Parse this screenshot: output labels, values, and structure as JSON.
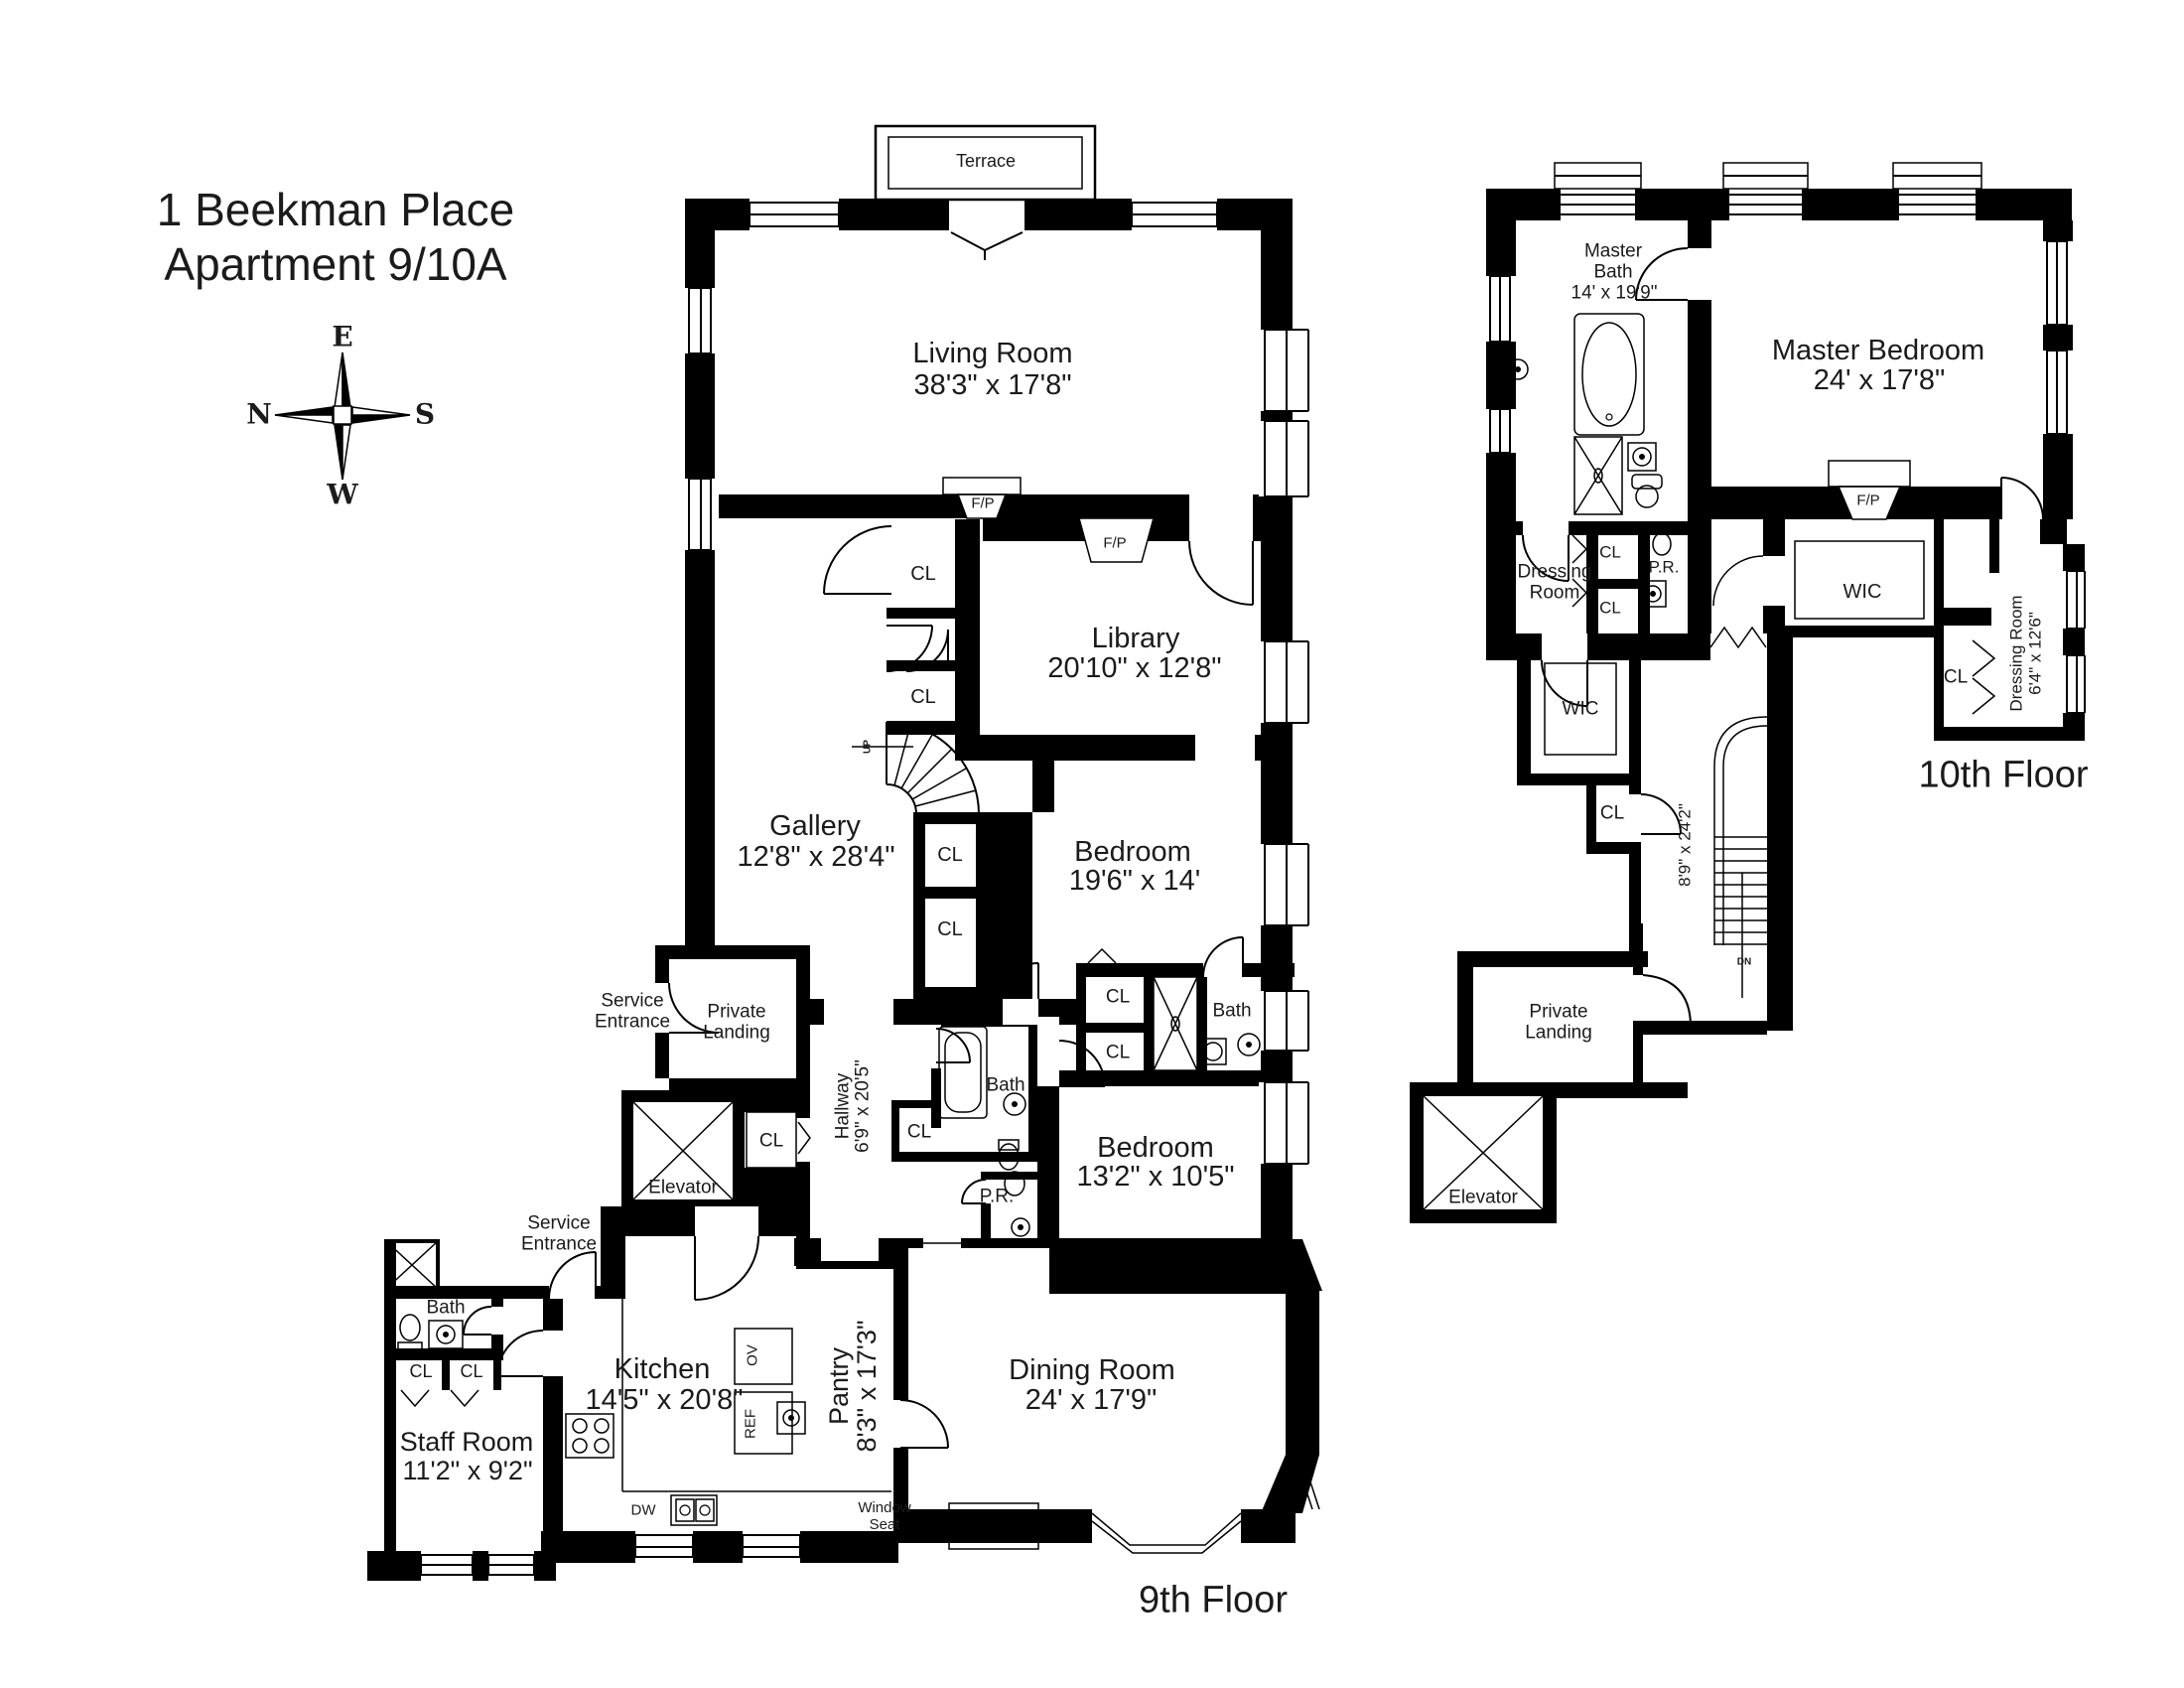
{
  "page": {
    "title_line1": "1 Beekman Place",
    "title_line2": "Apartment 9/10A"
  },
  "compass": {
    "e": "E",
    "n": "N",
    "s": "S",
    "w": "W"
  },
  "abbr": {
    "closet": "CL",
    "fireplace": "F/P",
    "powder_room": "P.R.",
    "walk_in_closet": "WIC",
    "up": "UP",
    "down": "DN",
    "dishwasher": "DW",
    "oven": "OV",
    "refrigerator": "REF"
  },
  "floor9": {
    "label": "9th Floor",
    "terrace": "Terrace",
    "living_room": {
      "name": "Living Room",
      "dims": "38'3\" x 17'8\""
    },
    "library": {
      "name": "Library",
      "dims": "20'10\" x 12'8\""
    },
    "gallery": {
      "name": "Gallery",
      "dims": "12'8\" x 28'4\""
    },
    "bedroom_large": {
      "name": "Bedroom",
      "dims": "19'6\" x 14'"
    },
    "bedroom_small": {
      "name": "Bedroom",
      "dims": "13'2\" x 10'5\""
    },
    "dining_room": {
      "name": "Dining Room",
      "dims": "24' x 17'9\""
    },
    "kitchen": {
      "name": "Kitchen",
      "dims": "14'5\" x 20'8\""
    },
    "pantry": {
      "name": "Pantry",
      "dims": "8'3\" x 17'3\""
    },
    "staff_room": {
      "name": "Staff Room",
      "dims": "11'2\" x 9'2\""
    },
    "hallway": {
      "name": "Hallway",
      "dims": "6'9\" x 20'5\""
    },
    "service_entrance": "Service\nEntrance",
    "private_landing": "Private\nLanding",
    "elevator": "Elevator",
    "window_seat": "Window\nSeat",
    "bath": "Bath"
  },
  "floor10": {
    "label": "10th Floor",
    "master_bath": {
      "name": "Master\nBath",
      "dims": "14' x 19'9\""
    },
    "master_bedroom": {
      "name": "Master Bedroom",
      "dims": "24' x 17'8\""
    },
    "dressing_room": "Dressing\nRoom",
    "dressing_room_right": {
      "name": "Dressing Room",
      "dims": "6'4\" x 12'6\""
    },
    "stairs_dims": "8'9\" x 24'2\"",
    "private_landing": "Private\nLanding",
    "elevator": "Elevator"
  }
}
